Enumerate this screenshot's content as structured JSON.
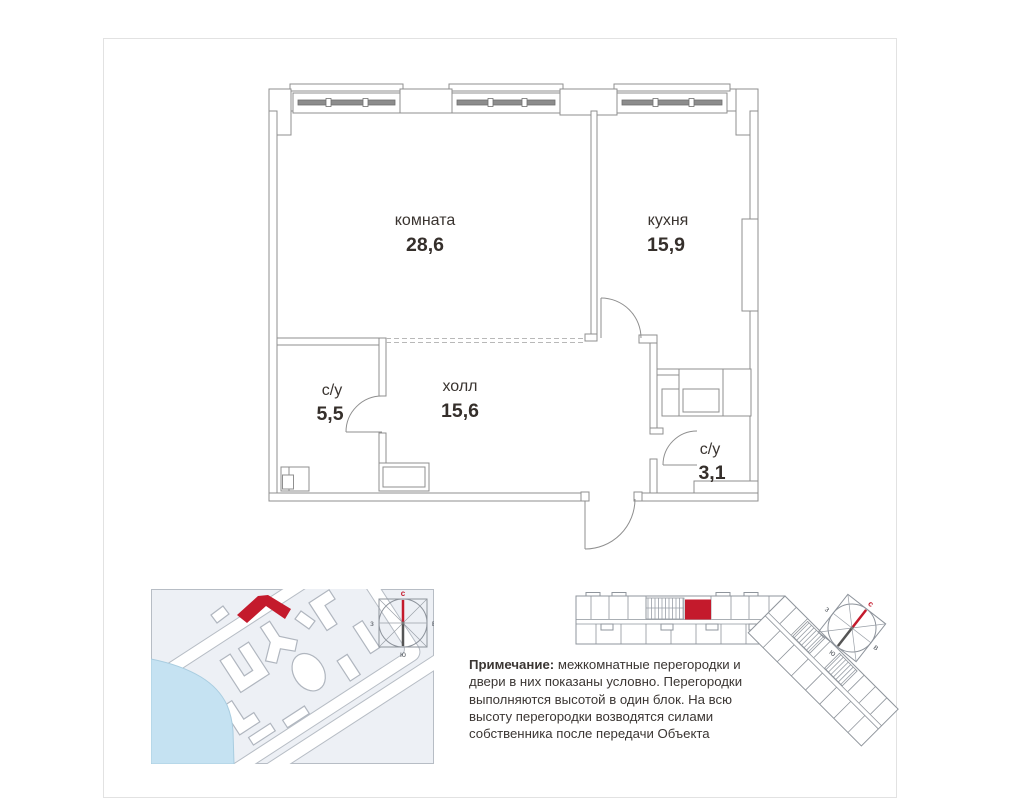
{
  "page": {
    "background": "#ffffff",
    "border_color": "#e2e2e2"
  },
  "floor_plan": {
    "line_color": "#8f8f8f",
    "text_color": "#3a3430",
    "rooms": [
      {
        "name": "комната",
        "area": "28,6"
      },
      {
        "name": "кухня",
        "area": "15,9"
      },
      {
        "name": "с/у",
        "area": "5,5"
      },
      {
        "name": "холл",
        "area": "15,6"
      },
      {
        "name": "с/у",
        "area": "3,1"
      }
    ]
  },
  "compass": {
    "north": "с",
    "west": "з",
    "east": "в",
    "south": "ю"
  },
  "site_map": {
    "background": "#edf0f5",
    "water_color": "#c5e2f2"
  },
  "colors": {
    "accent_red": "#c41a2c"
  },
  "note": {
    "label": "Примечание:",
    "line1": "межкомнатные перегородки и",
    "line2": "двери в них показаны условно. Перегородки",
    "line3": "выполняются высотой в один блок. На всю",
    "line4": "высоту перегородки возводятся силами",
    "line5": "собственника после передачи Объекта"
  }
}
